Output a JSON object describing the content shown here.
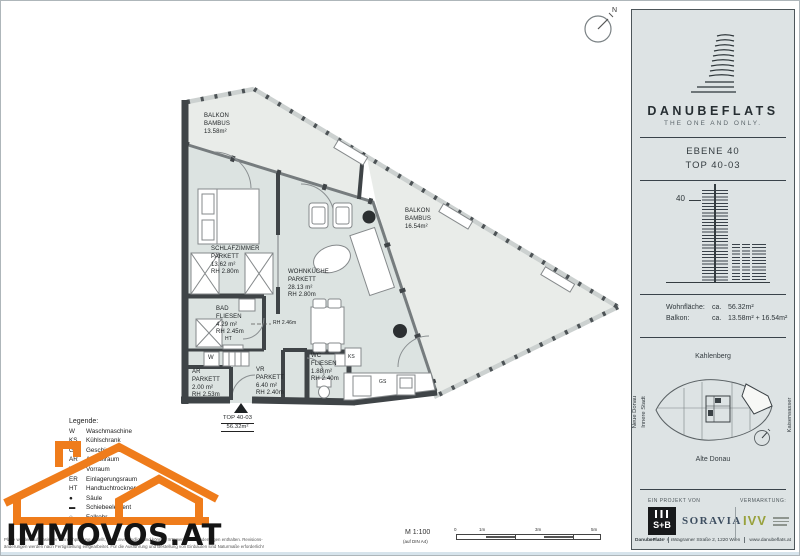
{
  "compass": {
    "n": "N"
  },
  "plan": {
    "balconies": [
      {
        "name": "BALKON",
        "material": "BAMBUS",
        "area": "13.58m²"
      },
      {
        "name": "BALKON",
        "material": "BAMBUS",
        "area": "16.54m²"
      }
    ],
    "rooms": [
      {
        "name": "SCHLAFZIMMER",
        "material": "PARKETT",
        "area": "13.62 m²",
        "rh": "RH 2.80m"
      },
      {
        "name": "WOHNKÜCHE",
        "material": "PARKETT",
        "area": "28.13 m²",
        "rh": "RH 2.80m"
      },
      {
        "name": "BAD",
        "material": "FLIESEN",
        "area": "4.29 m²",
        "rh": "RH 2.45m"
      },
      {
        "name": "AR",
        "material": "PARKETT",
        "area": "2.00 m²",
        "rh": "RH 2.53m"
      },
      {
        "name": "VR",
        "material": "PARKETT",
        "area": "6.40 m²",
        "rh": "RH 2.40m"
      },
      {
        "name": "WC",
        "material": "FLIESEN",
        "area": "1.88 m²",
        "rh": "RH 2.40m"
      }
    ],
    "note_rh": "RH 2.46m",
    "markers": {
      "washer": "W",
      "fridge": "KS",
      "dishwasher": "GS",
      "towel_dryer": "HT"
    },
    "entrance": {
      "unit": "TOP 40-03",
      "area": "56.32m²"
    }
  },
  "legend": {
    "title": "Legende:",
    "items": [
      {
        "abbr": "W",
        "label": "Waschmaschine"
      },
      {
        "abbr": "KS",
        "label": "Kühlschrank"
      },
      {
        "abbr": "GS",
        "label": "Geschirrspüler"
      },
      {
        "abbr": "AR",
        "label": "Abstellraum"
      },
      {
        "abbr": "VR",
        "label": "Vorraum"
      },
      {
        "abbr": "ER",
        "label": "Einlagerungsraum"
      },
      {
        "abbr": "HT",
        "label": "Handtuchtrockner"
      },
      {
        "abbr": "●",
        "label": "Säule"
      },
      {
        "abbr": "▬",
        "label": "Schiebeelement"
      },
      {
        "abbr": "○",
        "label": "Fallrohr"
      }
    ]
  },
  "scale": {
    "ratio": "M 1:100",
    "paper": "(auf DIN A4)",
    "t0": "0",
    "t1": "1m",
    "t2": "3m",
    "t3": "5m"
  },
  "watermark": {
    "text": "IMMOVOS.AT"
  },
  "disclaimer": {
    "line1": "Pläne wurden auf Basis der Einreichplanung erstellt, sind unverbindlich und können Irrtümer sowie Änderungen enthalten. Revisions-",
    "line2": "änderungen werden nach Fertigstellung eingearbeitet. Für die Ausführung und Bestellung von Einbauten sind Naturmaße erforderlich!"
  },
  "sidebar": {
    "brand": "DANUBEFLATS",
    "tagline": "THE ONE AND ONLY.",
    "level": "EBENE 40",
    "unit": "TOP 40-03",
    "tower_level": "40",
    "areas": [
      {
        "label": "Wohnfläche:",
        "approx": "ca.",
        "value": "56.32m²"
      },
      {
        "label": "Balkon:",
        "approx": "ca.",
        "value": "13.58m² + 16.54m²"
      }
    ],
    "map": {
      "north": "Kahlenberg",
      "south": "Alte Donau",
      "west1": "Neue Donau",
      "west2": "Innere Stadt",
      "east": "Kaiserwasser"
    },
    "project": {
      "left_header": "EIN PROJEKT VON",
      "right_header": "VERMARKTUNG:",
      "sb": "S+B",
      "sb_sub": "GRUPPE",
      "soravia": "SORAVIA",
      "ivv": "IVV"
    },
    "footer": {
      "brand": "DanubeFlats",
      "address": "Wagramer Straße 2, 1220 Wien",
      "web": "www.danubeflats.at"
    }
  }
}
